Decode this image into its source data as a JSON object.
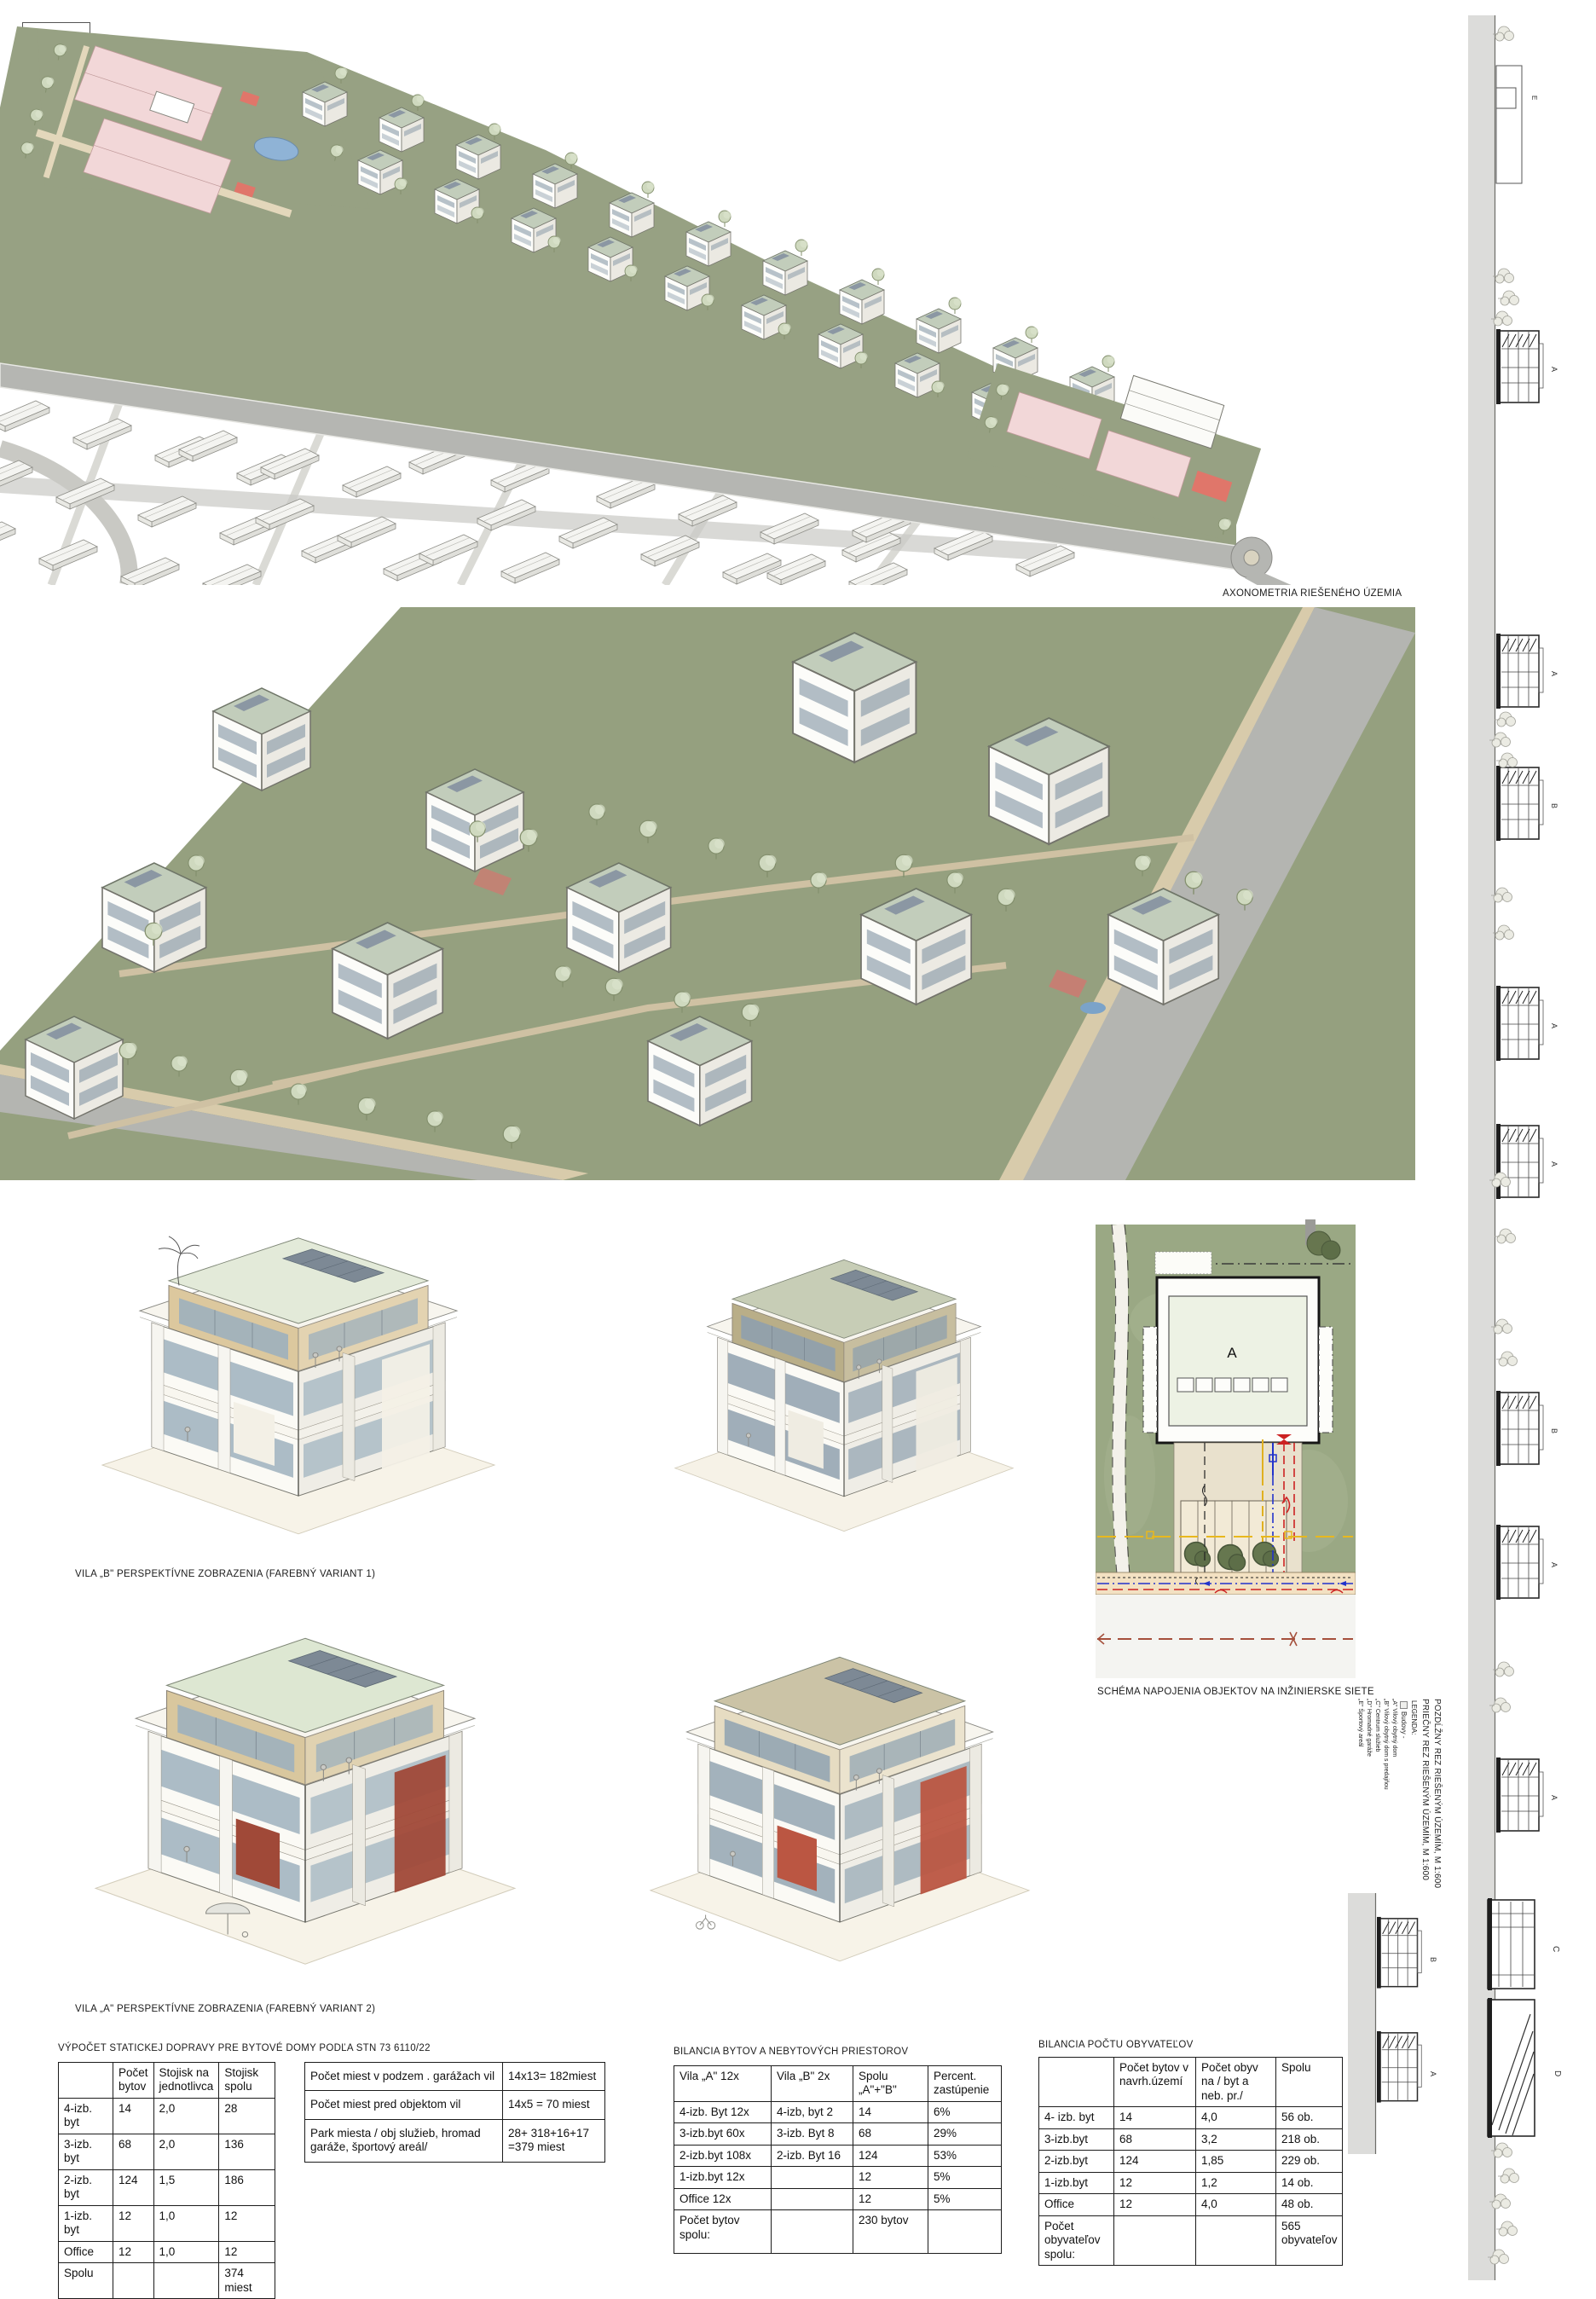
{
  "captions": {
    "axonometria": "AXONOMETRIA RIEŠENÉHO ÚZEMIA",
    "vila_b": "VILA „B\" PERSPEKTÍVNE ZOBRAZENIA (FAREBNÝ VARIANT 1)",
    "vila_a": "VILA „A\" PERSPEKTÍVNE ZOBRAZENIA (FAREBNÝ VARIANT 2)",
    "schema": "SCHÉMA NAPOJENIA OBJEKTOV NA INŽINIERSKE SIETE"
  },
  "schema": {
    "building_label": "A"
  },
  "sections_panel": {
    "title_line1": "POZDĹŽNY REZ RIEŠENÝM ÚZEMÍM, M 1:600",
    "title_line2": "PRIEČNY REZ RIEŠENÝM ÚZEMÍM, M 1:600",
    "legend_title": "LEGENDA:",
    "legend_buildings": "Budovy -",
    "legend_items": [
      "„A\" Vilový obytný dom",
      "„B\" Vilový obytný dom s predajňou",
      "„C\" Centrum služieb",
      "„D\" Hromadné garáže",
      "„E\" Športový areál"
    ]
  },
  "strip": {
    "labels": [
      "E",
      "A",
      "A",
      "B",
      "A",
      "A",
      "B",
      "A",
      "A",
      "C",
      "D"
    ],
    "cross_labels": [
      "B",
      "A"
    ]
  },
  "tables": {
    "parking": {
      "title": "VÝPOČET STATICKEJ DOPRAVY PRE BYTOVÉ DOMY PODĽA STN 73 6110/22",
      "headers": [
        "",
        "Počet bytov",
        "Stojisk na jednotlivca",
        "Stojisk spolu"
      ],
      "rows": [
        [
          "4-izb. byt",
          "14",
          "2,0",
          "28"
        ],
        [
          "3-izb. byt",
          "68",
          "2,0",
          "136"
        ],
        [
          "2-izb. byt",
          "124",
          "1,5",
          "186"
        ],
        [
          "1-izb. byt",
          "12",
          "1,0",
          "12"
        ],
        [
          "Office",
          "12",
          "1,0",
          "12"
        ],
        [
          "Spolu",
          "",
          "",
          "374 miest"
        ]
      ]
    },
    "parking_notes": {
      "rows": [
        [
          "Počet miest v podzem . garážach vil",
          "14x13= 182miest"
        ],
        [
          "Počet miest pred objektom vil",
          "14x5  = 70 miest"
        ],
        [
          "Park miesta / obj služieb, hromad garáže, športový areál/",
          "28+ 318+16+17 =379 miest"
        ]
      ]
    },
    "flats": {
      "title": "BILANCIA BYTOV A NEBYTOVÝCH PRIESTOROV",
      "headers": [
        "Vila „A\"  12x",
        "Vila „B\" 2x",
        "Spolu „A\"+\"B\"",
        "Percent. zastúpenie"
      ],
      "rows": [
        [
          "4-izb. Byt 12x",
          "4-izb, byt 2",
          "14",
          "6%"
        ],
        [
          "3-izb.byt 60x",
          "3-izb. Byt 8",
          "68",
          "29%"
        ],
        [
          "2-izb.byt 108x",
          "2-izb. Byt 16",
          "124",
          "53%"
        ],
        [
          "1-izb.byt 12x",
          "",
          "12",
          "5%"
        ],
        [
          "Office 12x",
          "",
          "12",
          "5%"
        ],
        [
          "Počet bytov spolu:",
          "",
          "230 bytov",
          ""
        ]
      ]
    },
    "population": {
      "title": "BILANCIA POČTU OBYVATEĽOV",
      "headers": [
        "",
        "Počet bytov v navrh.území",
        "Počet obyv na / byt a neb. pr./",
        "Spolu"
      ],
      "rows": [
        [
          "4- izb. byt",
          "14",
          "4,0",
          "56 ob."
        ],
        [
          "3-izb.byt",
          "68",
          "3,2",
          "218 ob."
        ],
        [
          "2-izb.byt",
          "124",
          "1,85",
          "229 ob."
        ],
        [
          "1-izb.byt",
          "12",
          "1,2",
          "14 ob."
        ],
        [
          "Office",
          "12",
          "4,0",
          "48 ob."
        ],
        [
          "Počet obyvateľov spolu:",
          "",
          "",
          "565 obyvateľov"
        ]
      ]
    }
  },
  "colors": {
    "lawn_green": "#97a183",
    "road_gray": "#b5b6b2",
    "path_beige": "#d8cbab",
    "roof_sage": "#c2cdbb",
    "court_pink": "#f2d7d8",
    "accent_red": "#e0766a",
    "villa_red": "#a04938",
    "pool_blue": "#8fb3d6",
    "utility_red": "#cc2222",
    "utility_blue": "#2233cc",
    "utility_yellow": "#e0b020"
  }
}
